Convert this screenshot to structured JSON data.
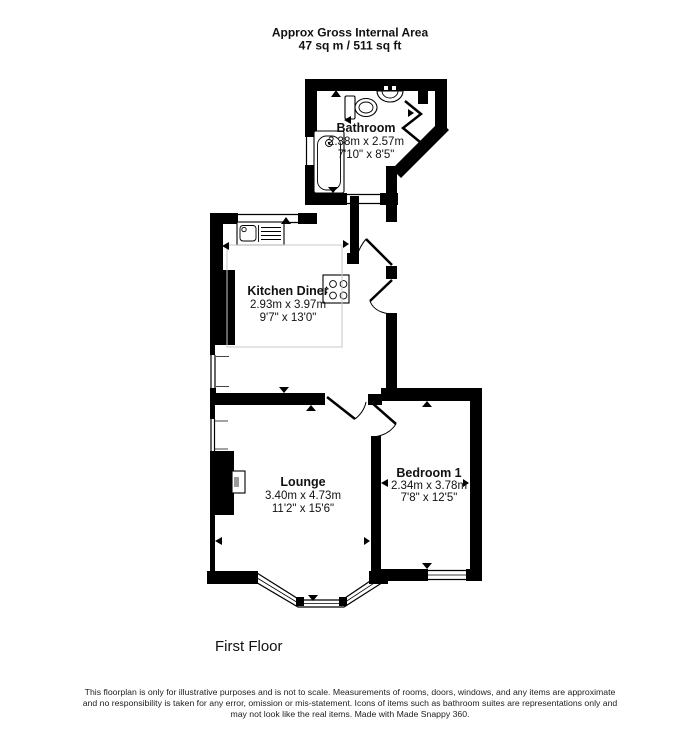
{
  "header": {
    "line1": "Approx Gross Internal Area",
    "line2": "47 sq m / 511 sq ft"
  },
  "rooms": [
    {
      "name": "Bathroom",
      "metric": "2.38m x 2.57m",
      "imperial": "7'10\" x 8'5\""
    },
    {
      "name": "Kitchen Diner",
      "metric": "2.93m x 3.97m",
      "imperial": "9'7\" x 13'0\""
    },
    {
      "name": "Lounge",
      "metric": "3.40m x 4.73m",
      "imperial": "11'2\" x 15'6\""
    },
    {
      "name": "Bedroom 1",
      "metric": "2.34m x 3.78m",
      "imperial": "7'8\" x 12'5\""
    }
  ],
  "floor_label": "First Floor",
  "disclaimer": {
    "line1": "This floorplan is only for illustrative purposes and is not to scale. Measurements of rooms, doors, windows, and any items are approximate",
    "line2": "and no responsibility is taken for any error, omission or mis-statement. Icons of items such as bathroom suites are representations only and",
    "line3": "may not look like the real items. Made with Made Snappy 360."
  },
  "colors": {
    "walls": "#000000",
    "background": "#ffffff",
    "dimension_box": "#c8c8c8"
  }
}
